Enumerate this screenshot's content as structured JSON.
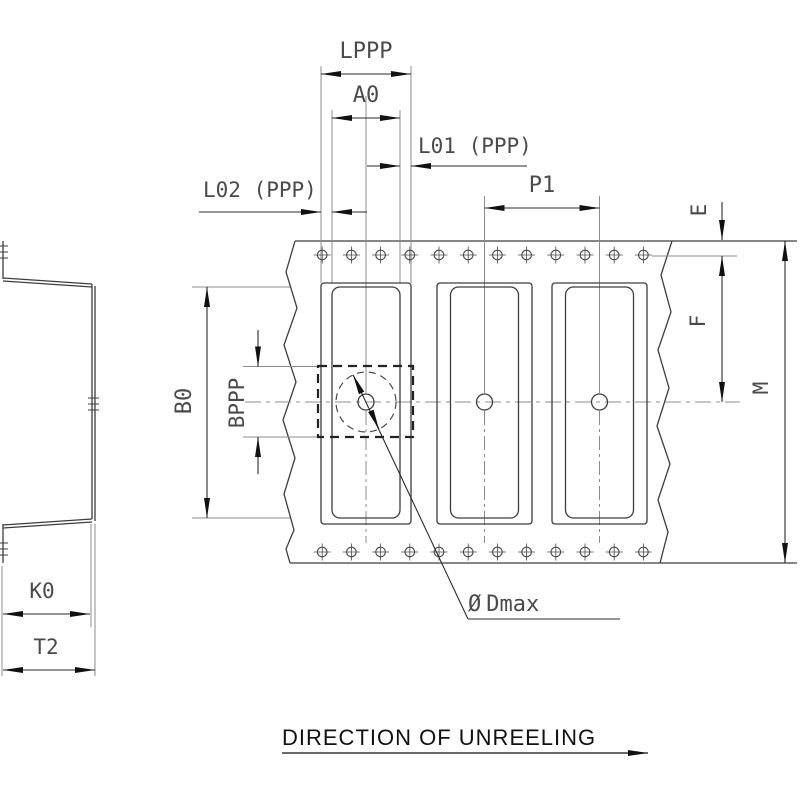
{
  "dimension_labels": {
    "lppp": "LPPP",
    "a0": "A0",
    "l01": "L01 (PPP)",
    "l02": "L02 (PPP)",
    "p1": "P1",
    "e": "E",
    "f": "F",
    "m": "M",
    "b0": "B0",
    "bppp": "BPPP",
    "k0": "K0",
    "t2": "T2"
  },
  "annotations": {
    "diameter_symbol": "Ø",
    "dmax_main": "D",
    "dmax_sub": "max",
    "direction_of_unreeling": "DIRECTION OF UNREELING"
  },
  "colors": {
    "background": "#ffffff",
    "object_line": "#3d3d3d",
    "dimension_line": "#2b2b2b",
    "extension_line": "#8c8c8c",
    "arrow_fill": "#111111",
    "text": "#4a4a4a",
    "footer_text": "#111111"
  }
}
